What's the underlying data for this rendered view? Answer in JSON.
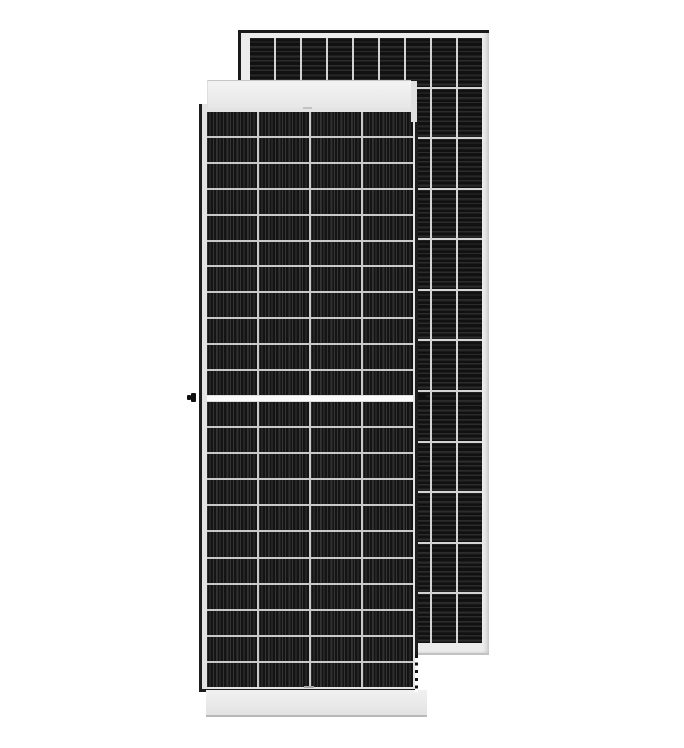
{
  "image": {
    "title": "Product photo: two framed black monocrystalline solar panels standing upright on a white background",
    "background": "#ffffff"
  },
  "rear_panel": {
    "description": "rear solar panel, portrait, partially hidden behind front panel",
    "columns": 9,
    "rows": 12,
    "colors": {
      "frame": "#ececec",
      "edge": "#1a1a1a",
      "grid_line": "#d4d4d4",
      "cell_base": "#111111",
      "cell_stripe": "#2c2c2c"
    }
  },
  "front_panel": {
    "description": "front solar panel, portrait, half-cut cell layout with central white gap",
    "columns": 4,
    "rows_upper": 11,
    "rows_lower": 11,
    "colors": {
      "border": "#1d1d1d",
      "inner_frame": "#e3e3e3",
      "grid_line": "#c9c9c9",
      "cell_base": "#141414",
      "cell_stripe": "#343434",
      "top_cap_edge": "#c6c6c6",
      "center_gap": "#fafafa",
      "hardware": "#101010"
    }
  }
}
